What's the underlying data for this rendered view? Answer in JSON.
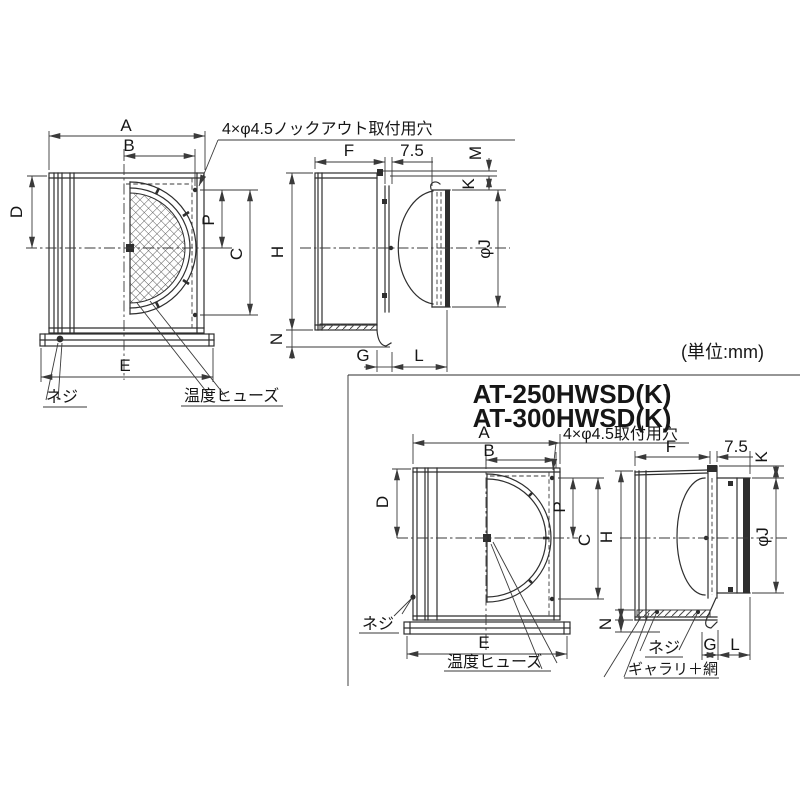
{
  "colors": {
    "line": "#2e2e2e",
    "text": "#161616",
    "background": "#ffffff"
  },
  "section": {
    "unit_note": "(単位:mm)",
    "model_line1": "AT-250HWSD(K)",
    "model_line2": "AT-300HWSD(K)"
  },
  "top_front": {
    "callout": "4×φ4.5ノックアウト取付用穴",
    "dim_a": "A",
    "dim_b": "B",
    "dim_d": "D",
    "dim_p": "P",
    "dim_c": "C",
    "dim_e": "E",
    "screw_label": "ネジ",
    "fuse_label": "温度ヒューズ"
  },
  "top_side": {
    "dim_f": "F",
    "dim_75": "7.5",
    "dim_m": "M",
    "dim_k": "K",
    "dim_h": "H",
    "dim_n": "N",
    "dim_g": "G",
    "dim_l": "L",
    "dim_phij": "φJ"
  },
  "bottom_front": {
    "callout": "4×φ4.5取付用穴",
    "dim_a": "A",
    "dim_b": "B",
    "dim_d": "D",
    "dim_p": "P",
    "dim_c": "C",
    "dim_e": "E",
    "screw_label": "ネジ",
    "fuse_label": "温度ヒューズ"
  },
  "bottom_side": {
    "dim_f": "F",
    "dim_75": "7.5",
    "dim_k": "K",
    "dim_h": "H",
    "dim_n": "N",
    "dim_g": "G",
    "dim_l": "L",
    "dim_phij": "φJ",
    "screw_label": "ネジ",
    "gallery_label": "ギャラリ＋網"
  }
}
